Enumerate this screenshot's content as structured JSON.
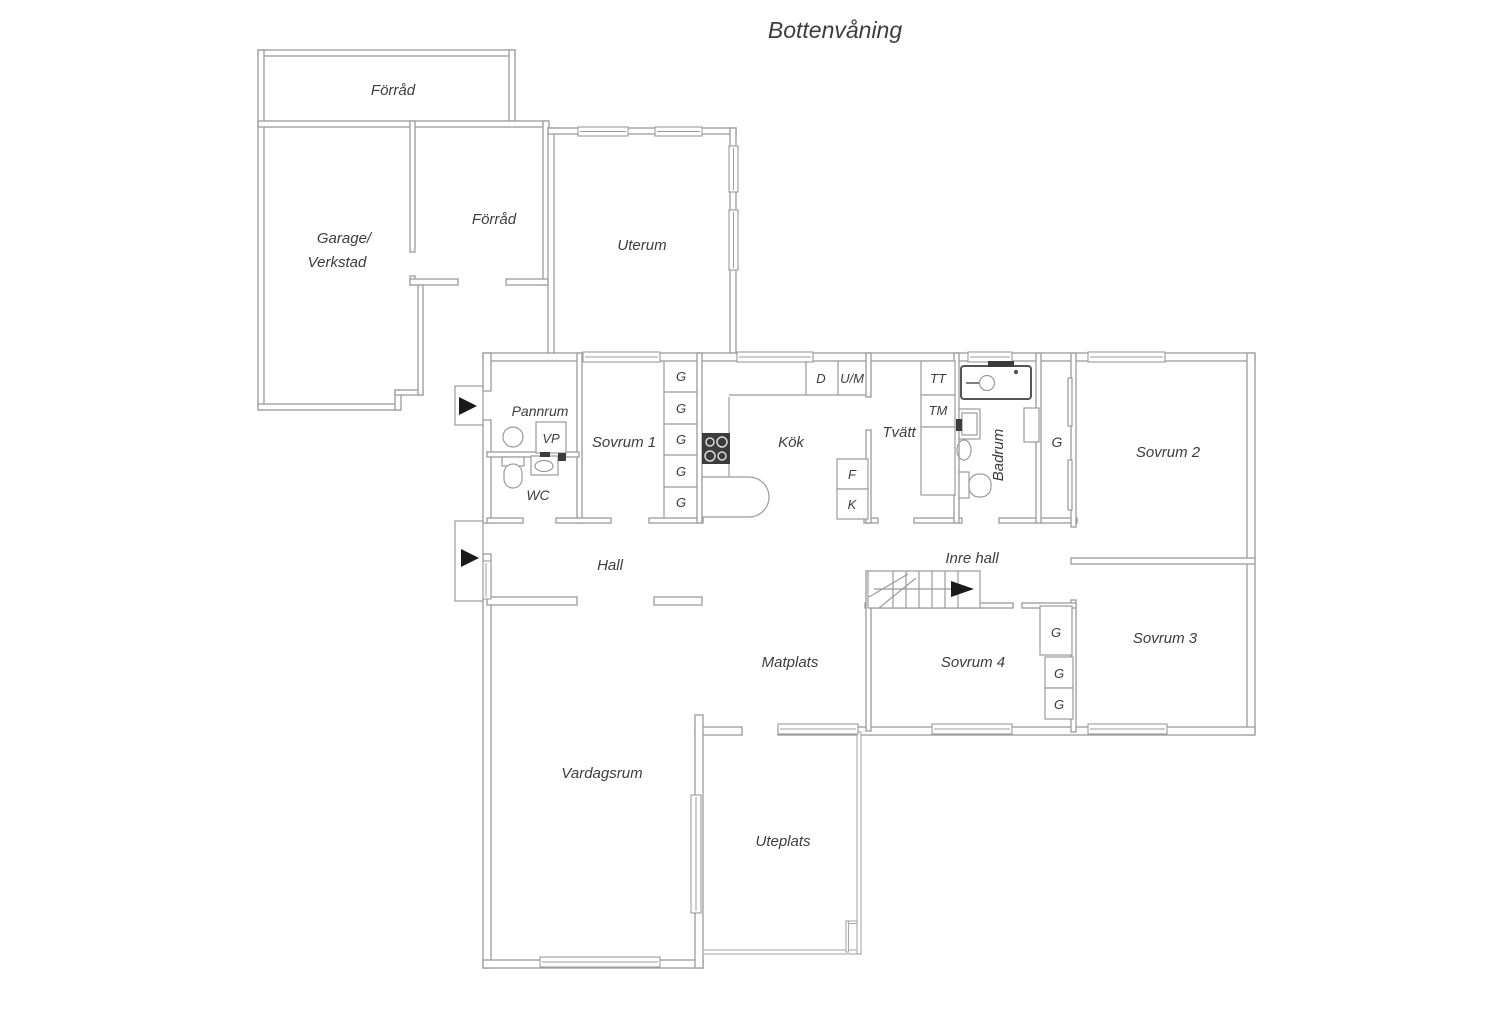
{
  "title": "Bottenvåning",
  "rooms": {
    "forrad_top": "Förråd",
    "garage_line1": "Garage/",
    "garage_line2": "Verkstad",
    "forrad_inner": "Förråd",
    "uterum": "Uterum",
    "pannrum": "Pannrum",
    "wc": "WC",
    "sovrum1": "Sovrum 1",
    "kok": "Kök",
    "tvatt": "Tvätt",
    "badrum": "Badrum",
    "sovrum2": "Sovrum 2",
    "hall": "Hall",
    "inre_hall": "Inre hall",
    "matplats": "Matplats",
    "sovrum4": "Sovrum 4",
    "sovrum3": "Sovrum 3",
    "vardagsrum": "Vardagsrum",
    "uteplats": "Uteplats"
  },
  "appliances": {
    "closet": "G",
    "heat_pump": "VP",
    "dishwasher": "D",
    "oven_micro": "U/M",
    "dryer": "TT",
    "washer": "TM",
    "freezer": "F",
    "fridge": "K"
  },
  "colors": {
    "wall": "#9b9b9b",
    "text": "#3d3d3d",
    "fixture_dark": "#3c3c3c",
    "background": "#ffffff"
  }
}
